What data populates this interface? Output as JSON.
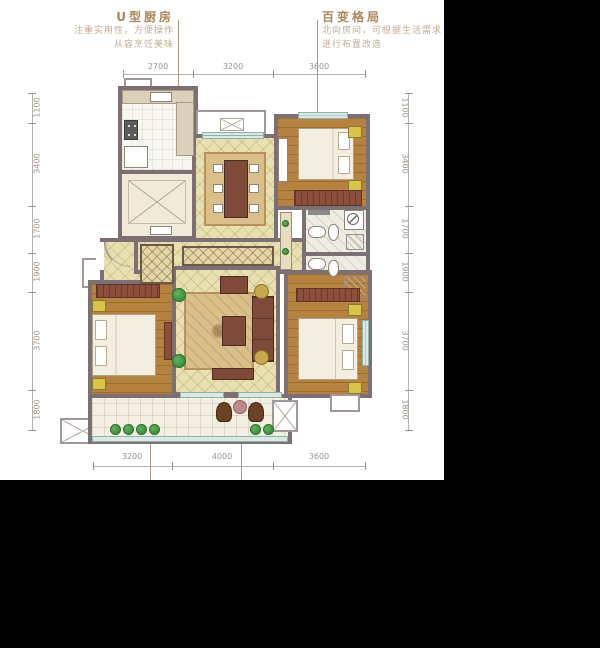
{
  "window": {
    "bg": "#000000"
  },
  "panel": {
    "bg": "#ffffff"
  },
  "annotations": {
    "kitchen": {
      "title": "U型厨房",
      "desc_line1": "注重实用性，方便操作",
      "desc_line2": "从容烹饪美味"
    },
    "flexible": {
      "title": "百变格局",
      "desc_line1": "北向房间，可根据生活需求",
      "desc_line2": "进行布置改造"
    }
  },
  "dimensions": {
    "top": [
      "2700",
      "3200",
      "3600"
    ],
    "bottom": [
      "3200",
      "4000",
      "3600"
    ],
    "left": [
      "1100",
      "3400",
      "1700",
      "1900",
      "3700",
      "1800"
    ],
    "right": [
      "1100",
      "3400",
      "1700",
      "1900",
      "3700",
      "1800"
    ]
  },
  "colors": {
    "windowBg": "#000000",
    "panelBg": "#ffffff",
    "wall": "#7c7074",
    "accentTitle": "#ab8558",
    "accentDesc": "#c3ab8e",
    "dimText": "#9a938d",
    "dimLine": "#b9b2ac",
    "leader": "#b09a82",
    "woodFloor": "#b5823f",
    "tileBeige": "#e9e0b2",
    "rugBeige": "#d9c08a",
    "furnitureDark": "#7e4a3a",
    "wardrobe": "#8a4f3d",
    "nightstand": "#d8c44a",
    "windowTeal": "#bcd8d0",
    "plantGreen": "#3f8f3d",
    "bathFloor": "#efede2",
    "balconyFloor": "#f3efe2",
    "bedWhite": "#f3eedf"
  }
}
